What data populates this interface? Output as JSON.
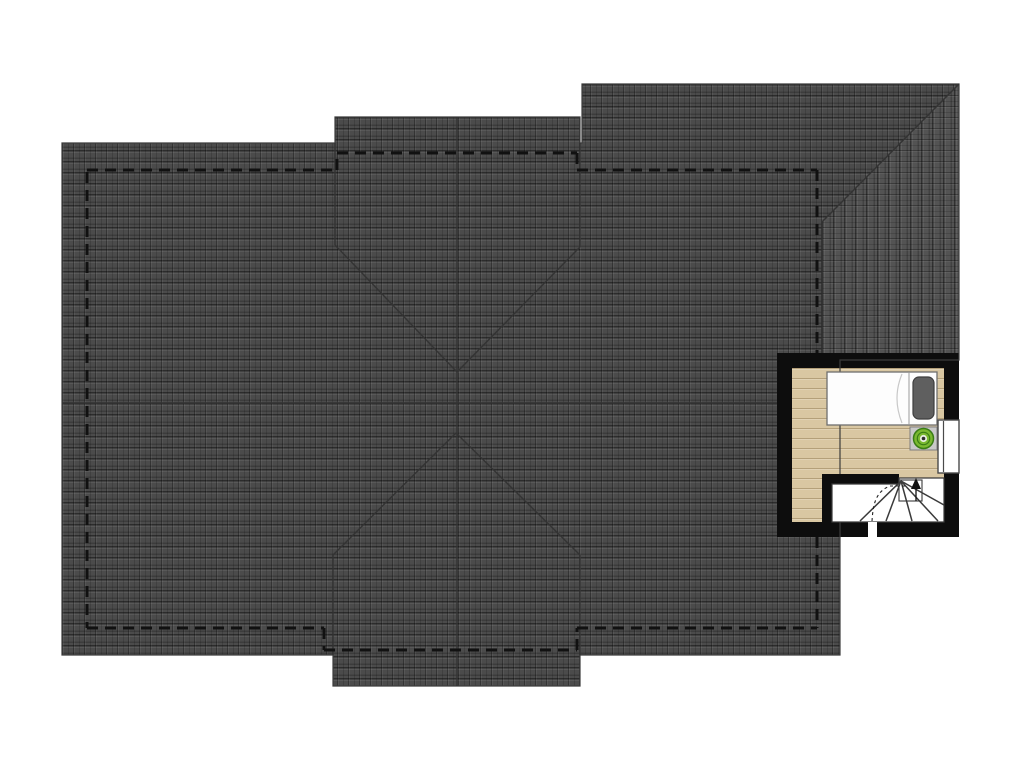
{
  "plan": {
    "title": "attic-roof-plan",
    "canvas": {
      "w": 1024,
      "h": 768
    },
    "colors": {
      "background": "#ffffff",
      "roof_tile": "#4b4b4b",
      "roof_tile_wing": "#535353",
      "roof_line": "#333333",
      "roof_outline": "#3c3c3c",
      "wall_dash": "#111111",
      "room_wall": "#0d0d0d",
      "floor_wood": "#d9c7a2",
      "bed_fill": "#fdfdfd",
      "bed_stroke": "#6f6f6f",
      "pillow_fill": "#5f5f5f",
      "pillow_stroke": "#3e3e3e",
      "nightstand_fill": "#c9c9c9",
      "nightstand_stroke": "#7e7e7e",
      "plant_green": "#7ab930",
      "plant_ring": "#3a7d15",
      "plant_center": "#e9efe2",
      "stair_line": "#3a3a3a",
      "window_fill": "#ffffff",
      "window_stroke": "#4a4a4a"
    },
    "roof": {
      "footprint": [
        [
          62,
          143
        ],
        [
          335,
          143
        ],
        [
          335,
          117
        ],
        [
          580,
          117
        ],
        [
          580,
          143
        ],
        [
          582,
          143
        ],
        [
          582,
          84
        ],
        [
          959,
          84
        ],
        [
          959,
          360
        ],
        [
          840,
          360
        ],
        [
          840,
          655
        ],
        [
          580,
          655
        ],
        [
          580,
          686
        ],
        [
          333,
          686
        ],
        [
          333,
          655
        ],
        [
          62,
          655
        ]
      ],
      "wing_east_plane": [
        [
          959,
          84
        ],
        [
          822,
          222
        ],
        [
          822,
          353
        ],
        [
          959,
          353
        ]
      ],
      "solid_lines": [
        {
          "name": "main-ridge",
          "x1": 62,
          "y1": 403,
          "x2": 777,
          "y2": 403
        },
        {
          "name": "cross-ridge",
          "x1": 457,
          "y1": 117,
          "x2": 457,
          "y2": 686
        },
        {
          "name": "valley-top-left",
          "x1": 335,
          "y1": 245,
          "x2": 457,
          "y2": 372
        },
        {
          "name": "valley-top-right",
          "x1": 580,
          "y1": 247,
          "x2": 457,
          "y2": 372
        },
        {
          "name": "valley-bottom-left",
          "x1": 333,
          "y1": 555,
          "x2": 456,
          "y2": 433
        },
        {
          "name": "valley-bottom-right",
          "x1": 580,
          "y1": 555,
          "x2": 456,
          "y2": 433
        },
        {
          "name": "gable-edge-top-left",
          "x1": 335,
          "y1": 143,
          "x2": 335,
          "y2": 245
        },
        {
          "name": "gable-edge-top-right",
          "x1": 580,
          "y1": 143,
          "x2": 580,
          "y2": 247
        },
        {
          "name": "gable-edge-bottom-left",
          "x1": 333,
          "y1": 555,
          "x2": 333,
          "y2": 655
        },
        {
          "name": "gable-edge-bottom-right",
          "x1": 580,
          "y1": 555,
          "x2": 580,
          "y2": 655
        },
        {
          "name": "wing-hip",
          "x1": 959,
          "y1": 84,
          "x2": 822,
          "y2": 222
        },
        {
          "name": "wing-main-edge",
          "x1": 822,
          "y1": 222,
          "x2": 822,
          "y2": 353
        }
      ],
      "dashed_wall_lines": [
        [
          87,
          172,
          87,
          628
        ],
        [
          87,
          170,
          337,
          170
        ],
        [
          337,
          170,
          337,
          153
        ],
        [
          337,
          153,
          577,
          153
        ],
        [
          577,
          153,
          577,
          170
        ],
        [
          577,
          170,
          817,
          170
        ],
        [
          817,
          170,
          817,
          353
        ],
        [
          817,
          537,
          817,
          628
        ],
        [
          577,
          628,
          817,
          628
        ],
        [
          87,
          628,
          324,
          628
        ],
        [
          324,
          628,
          324,
          650
        ],
        [
          324,
          650,
          577,
          650
        ],
        [
          577,
          650,
          577,
          628
        ]
      ],
      "dash_pattern": "11 7",
      "dash_width": 3
    },
    "room": {
      "outer": [
        777,
        353,
        182,
        184
      ],
      "inner": [
        792,
        368,
        152,
        154
      ],
      "bed": {
        "rect": [
          827,
          372,
          110,
          53
        ],
        "divider_x": 909,
        "pillow": [
          913,
          377,
          21,
          42
        ],
        "fold": "M 902,374 Q 892,398 902,423"
      },
      "nightstand": [
        910,
        427,
        27,
        23
      ],
      "plant": {
        "cx": 923.5,
        "cy": 438.5,
        "r": 10
      },
      "window": {
        "rect": [
          938,
          420,
          21,
          53
        ],
        "glass_x": 943.5
      },
      "stairs": {
        "wall_top": [
          822,
          474,
          77,
          10
        ],
        "wall_left": [
          822,
          484,
          10,
          38
        ],
        "well": [
          [
            832,
            484
          ],
          [
            899,
            484
          ],
          [
            899,
            478
          ],
          [
            944,
            478
          ],
          [
            944,
            522
          ],
          [
            832,
            522
          ]
        ],
        "fan_origin": [
          901,
          481
        ],
        "fan_ends": [
          [
            860,
            521
          ],
          [
            886,
            521
          ],
          [
            912,
            521
          ],
          [
            938,
            521
          ],
          [
            944,
            505
          ]
        ],
        "tread_rect": [
          899,
          480,
          23,
          21
        ],
        "arrow_line": [
          916,
          501,
          916,
          488
        ],
        "arrow_head": [
          [
            911,
            489
          ],
          [
            921,
            489
          ],
          [
            916,
            478
          ]
        ],
        "walk_line": "M 872,521 C 873,508 874,492 890,486 L 906,486",
        "walk_dash": "3 3"
      },
      "door_gap": [
        868,
        522,
        9,
        15
      ]
    }
  }
}
